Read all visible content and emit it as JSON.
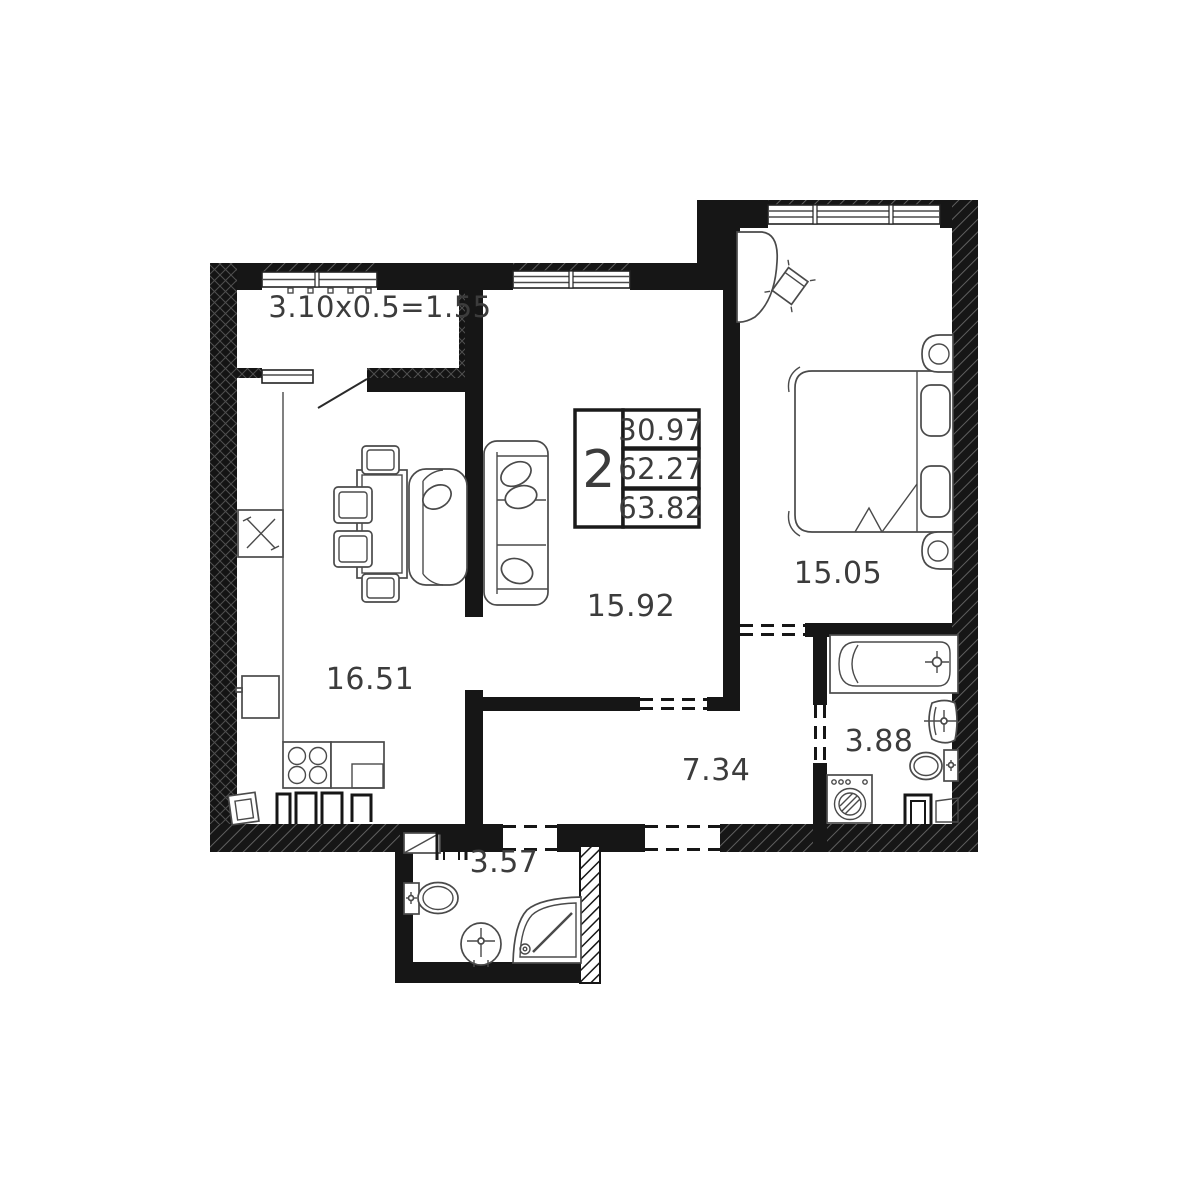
{
  "plan": {
    "balcony": {
      "label": "3.10x0.5=1.55"
    },
    "kitchen": {
      "area": "16.51"
    },
    "living": {
      "area": "15.92"
    },
    "bedroom": {
      "area": "15.05"
    },
    "hallway": {
      "area": "7.34"
    },
    "bathroom": {
      "area": "3.88"
    },
    "wc": {
      "area": "3.57"
    }
  },
  "legend": {
    "rooms": "2",
    "living_area": "30.97",
    "floor_area": "62.27",
    "total_area": "63.82"
  },
  "colors": {
    "wall": "#161616",
    "furniture_line": "#4a4a4a",
    "text": "#3c3c3c",
    "background": "#ffffff"
  }
}
